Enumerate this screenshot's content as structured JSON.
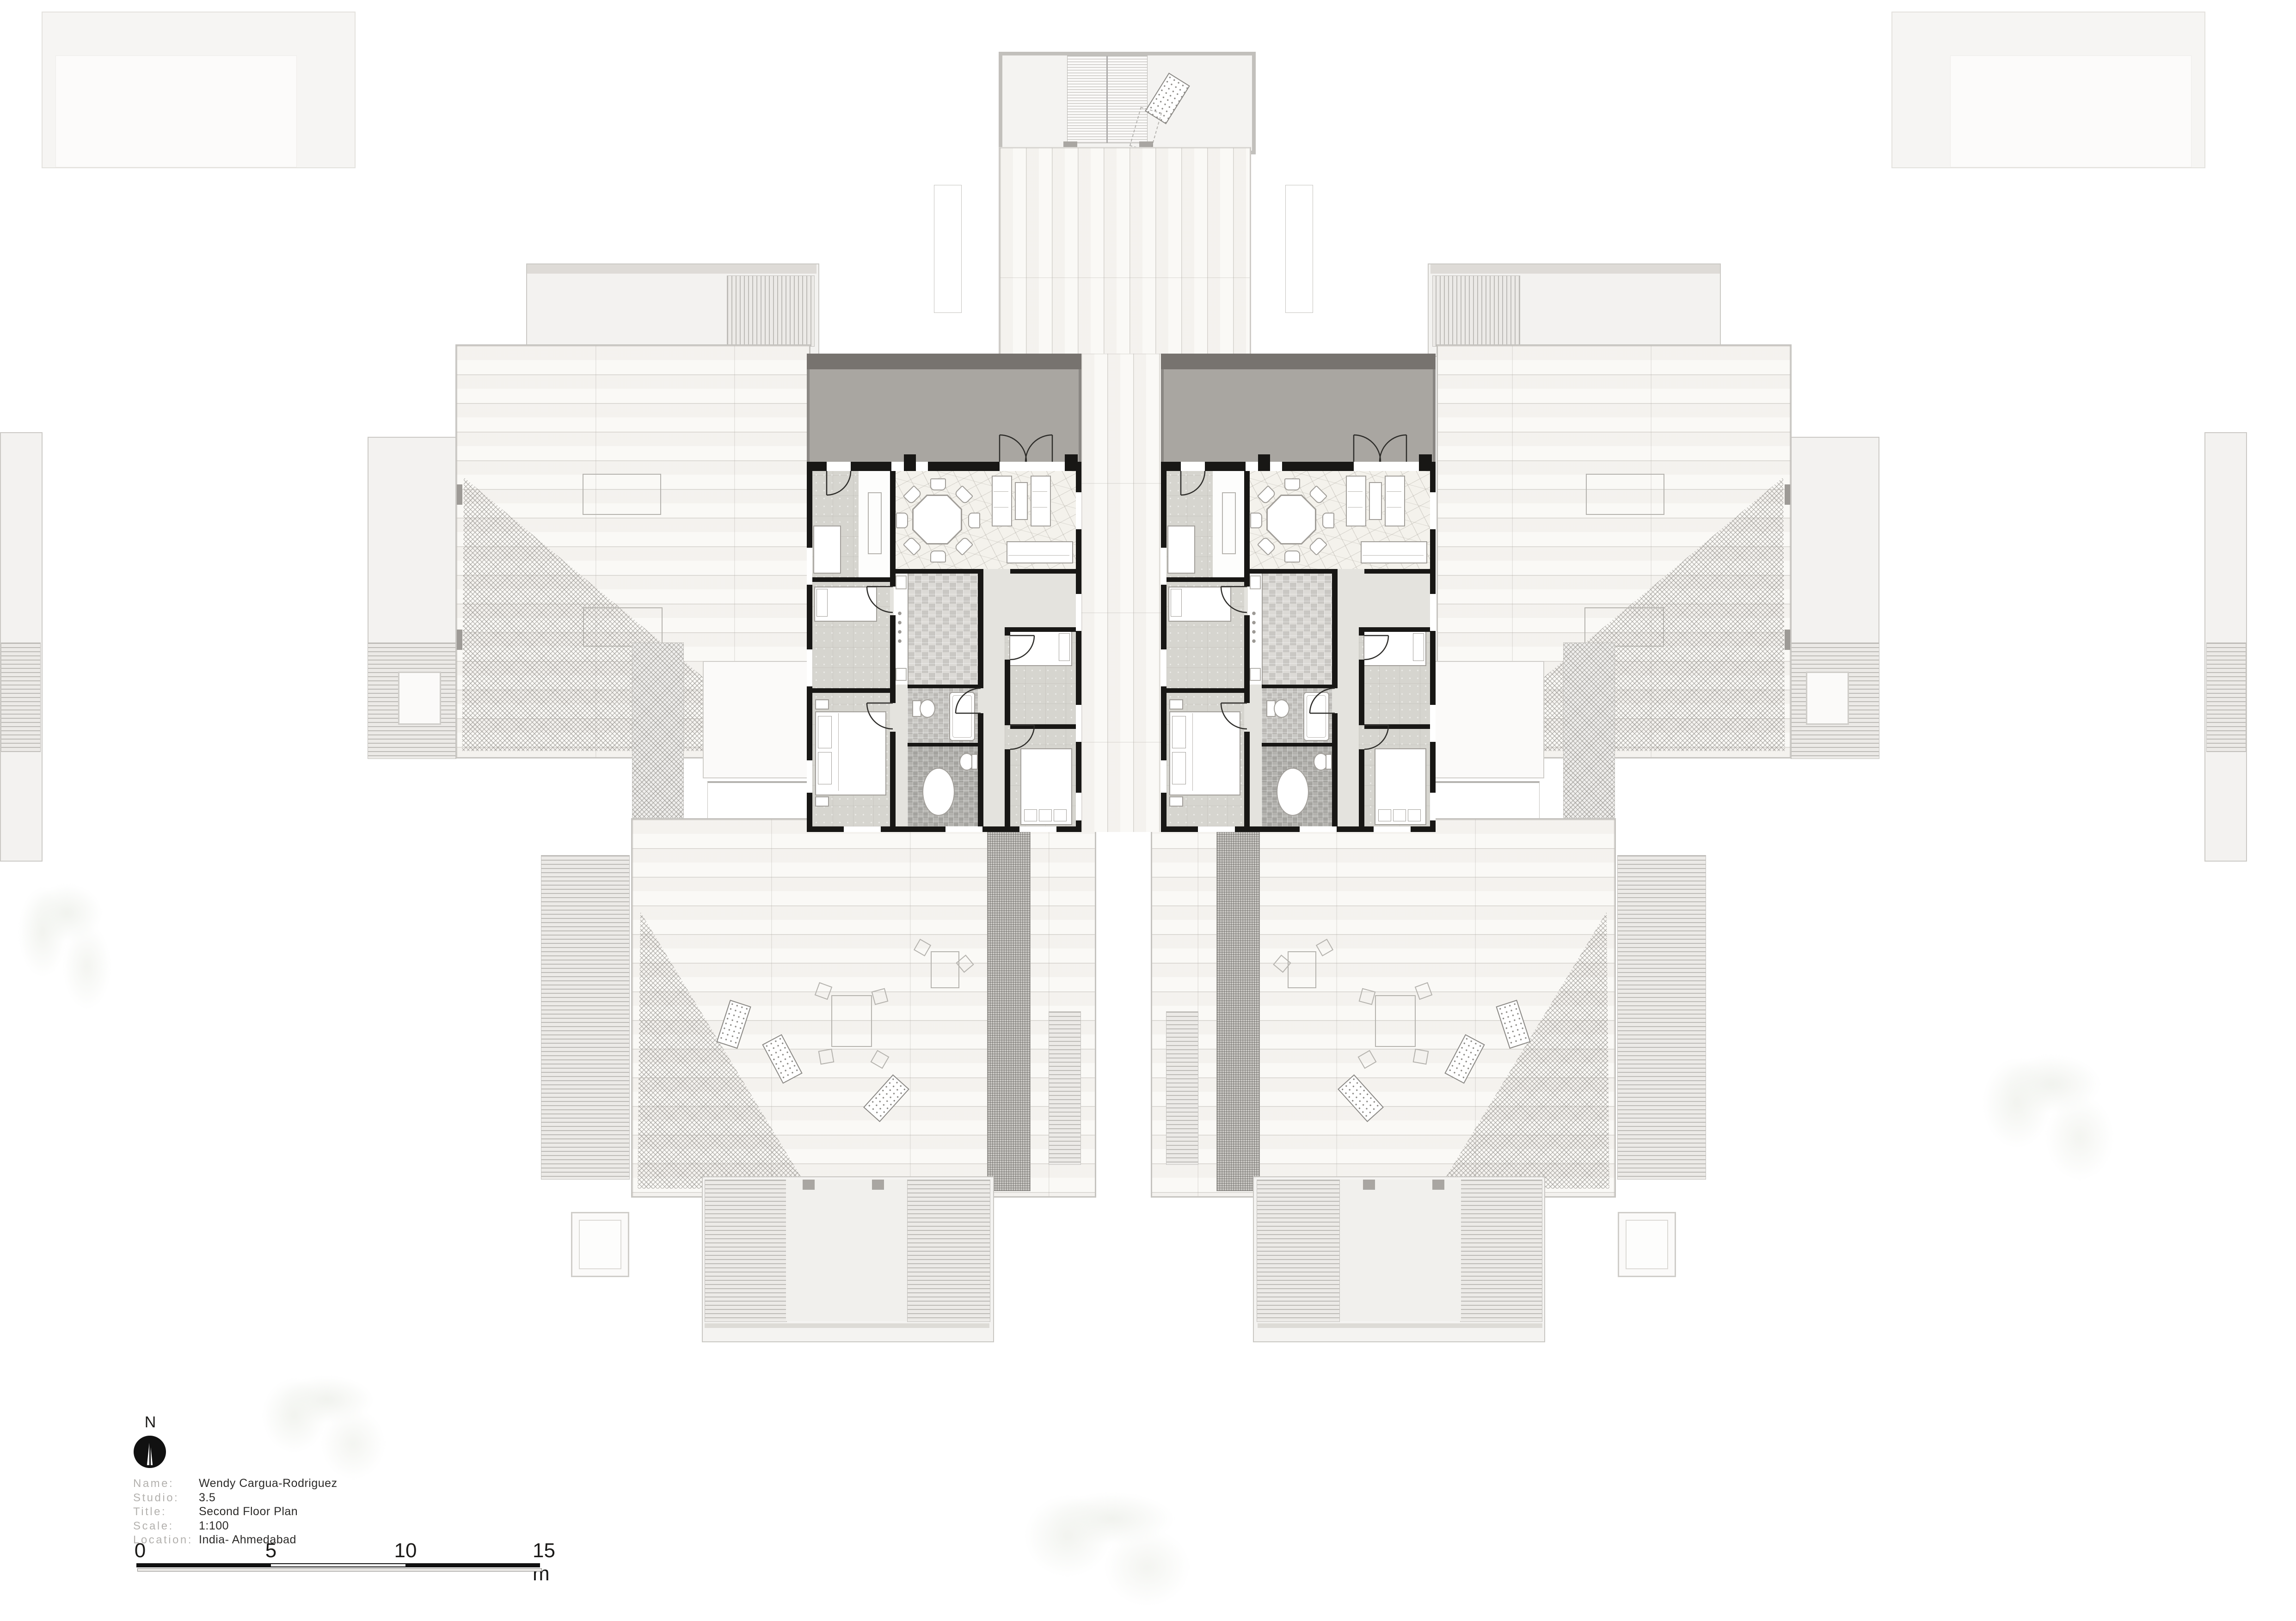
{
  "north": {
    "label": "N"
  },
  "title_block": {
    "fields": [
      {
        "label": "Name:",
        "value": "Wendy Cargua-Rodriguez"
      },
      {
        "label": "Studio:",
        "value": "3.5"
      },
      {
        "label": "Title:",
        "value": "Second Floor Plan"
      },
      {
        "label": "Scale:",
        "value": "1:100"
      },
      {
        "label": "Location:",
        "value": "India- Ahmedabad"
      }
    ]
  },
  "scale_bar": {
    "ticks": [
      "0",
      "5",
      "10",
      "15 m"
    ]
  },
  "colors": {
    "wall": "#181715",
    "roof_band": "#77736f",
    "balcony": "#a9a6a1",
    "hall_floor": "#e4e3de",
    "bedroom_floor": "#d6d5cf",
    "stone_floor": "#f4f2ec",
    "ghost_line": "#c9c7c3",
    "paper": "#ffffff"
  }
}
